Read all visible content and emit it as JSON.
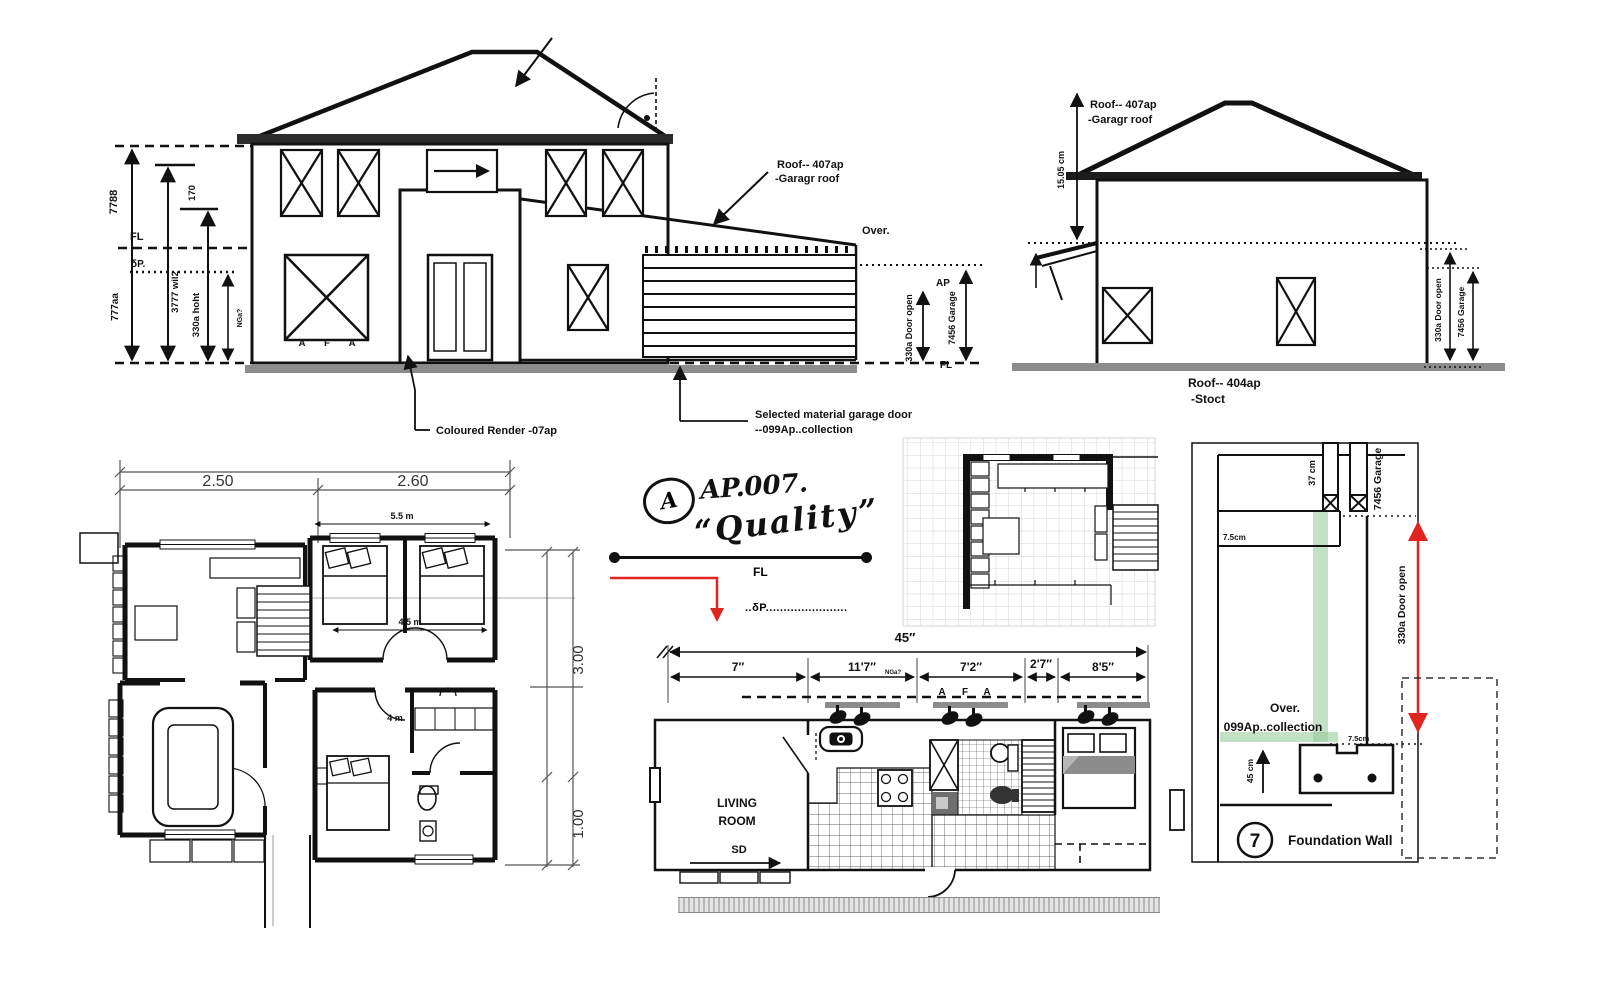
{
  "front_elevation": {
    "dim_7788": "7788",
    "dim_3777": "3777  wil2",
    "dim_170": "170",
    "dim_330a": "330a  hoht",
    "dim_nga": "NGa?",
    "dim_777aa": "777aa",
    "fl_left": "FL",
    "dp_left": "δP.",
    "letter_a1": "A",
    "letter_f": "F",
    "letter_a2": "A",
    "roof_note_line1": "Roof-- 407ap",
    "roof_note_line2": "-Garagr roof",
    "over_label": "Over.",
    "ap_label": "AP",
    "fl_right": "FL",
    "dim_door_open": "330a  Door open",
    "dim_garage": "7456 Garage",
    "render_note": "Coloured Render -07ap",
    "garage_note_line1": "Selected material garage door",
    "garage_note_line2": "--099Ap..collection"
  },
  "side_elevation": {
    "roof_note_line1": "Roof-- 407ap",
    "roof_note_line2": "-Garagr roof",
    "dim_roof_height": "15.05 cm",
    "dim_door_open": "330a  Door open",
    "dim_garage": "7456 Garage",
    "caption_line1": "Roof-- 404ap",
    "caption_line2": "-Stoct"
  },
  "floor_plan": {
    "dim_w_left": "2.50",
    "dim_w_right": "2.60",
    "dim_bedroom_w": "5.5 m",
    "dim_bedroom_inner": "4.5 m",
    "dim_room": "4 m",
    "dim_h_upper": "3.00",
    "dim_h_lower": "1.00"
  },
  "sketch_note": {
    "bubble_letter": "A",
    "code": "AP.007.",
    "word": "“Quality”",
    "fl_label": "FL",
    "dp_dotted": "..δP......................."
  },
  "long_plan": {
    "dim_total": "45″",
    "dim_seg1": "7″",
    "dim_seg2": "11'7″",
    "dim_seg2_sub": "NGa?",
    "dim_seg3": "7'2″",
    "dim_seg4": "2'7″",
    "dim_seg5": "8'5″",
    "letter_a1": "A",
    "letter_f": "F",
    "letter_a2": "A",
    "room_line1": "LIVING",
    "room_line2": "ROOM",
    "door_label": "SD",
    "dim_height": "11'5″"
  },
  "foundation_detail": {
    "dim_post": "37 cm",
    "dim_garage": "7456 Garage",
    "dim_wall_top": "7.5cm",
    "dim_door_open": "330a  Door open",
    "over_line1": "Over.",
    "over_line2": "099Ap..collection",
    "dim_wall_bottom": "7.5cm",
    "dim_footing": "45 cm",
    "bubble_number": "7",
    "title": "Foundation Wall"
  },
  "colors": {
    "line": "#111111",
    "red_accent": "#e02520",
    "green_band": "#c3e2c5",
    "ground_gray": "#8c8c8c"
  }
}
